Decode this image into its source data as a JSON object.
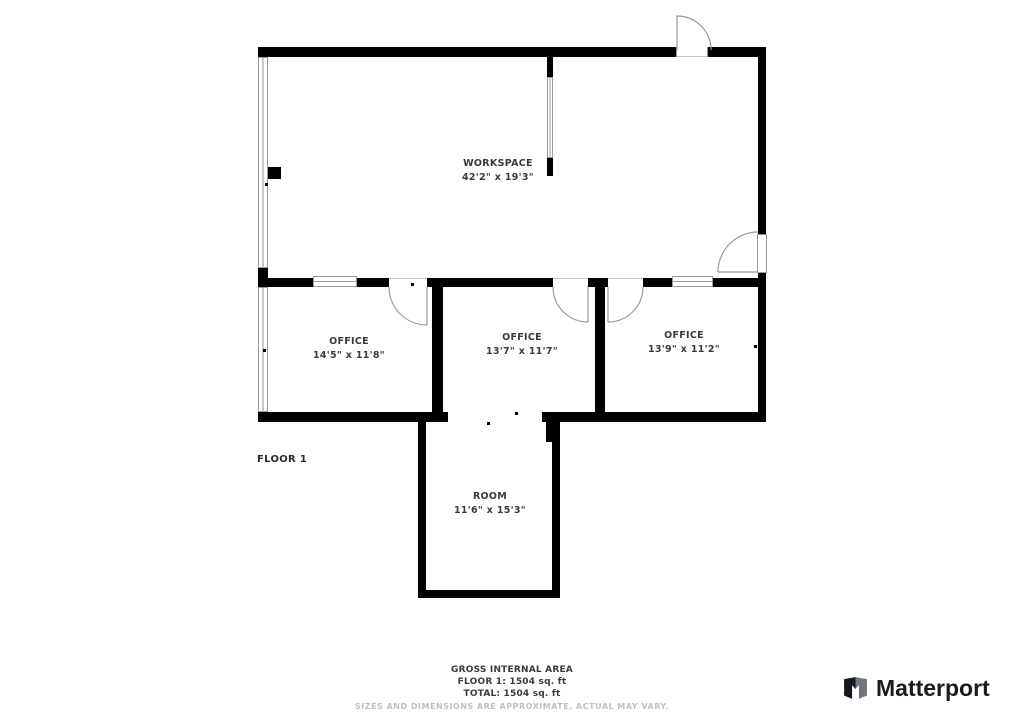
{
  "floor_label": "FLOOR 1",
  "rooms": [
    {
      "name": "WORKSPACE",
      "dimensions": "42'2\" x 19'3\""
    },
    {
      "name": "OFFICE",
      "dimensions": "14'5\" x 11'8\""
    },
    {
      "name": "OFFICE",
      "dimensions": "13'7\" x 11'7\""
    },
    {
      "name": "OFFICE",
      "dimensions": "13'9\" x 11'2\""
    },
    {
      "name": "ROOM",
      "dimensions": "11'6\" x 15'3\""
    }
  ],
  "summary": {
    "title": "GROSS INTERNAL AREA",
    "floor_area": "FLOOR 1: 1504 sq. ft",
    "total_area": "TOTAL: 1504 sq. ft",
    "disclaimer": "SIZES AND DIMENSIONS ARE APPROXIMATE, ACTUAL MAY VARY."
  },
  "branding": {
    "logo_text": "Matterport"
  },
  "colors": {
    "wall": "#000000",
    "thin_line": "#9a9a9a",
    "label_text": "#3a3a3a",
    "disclaimer_text": "#c0c0c0",
    "logo_text": "#181b22"
  }
}
